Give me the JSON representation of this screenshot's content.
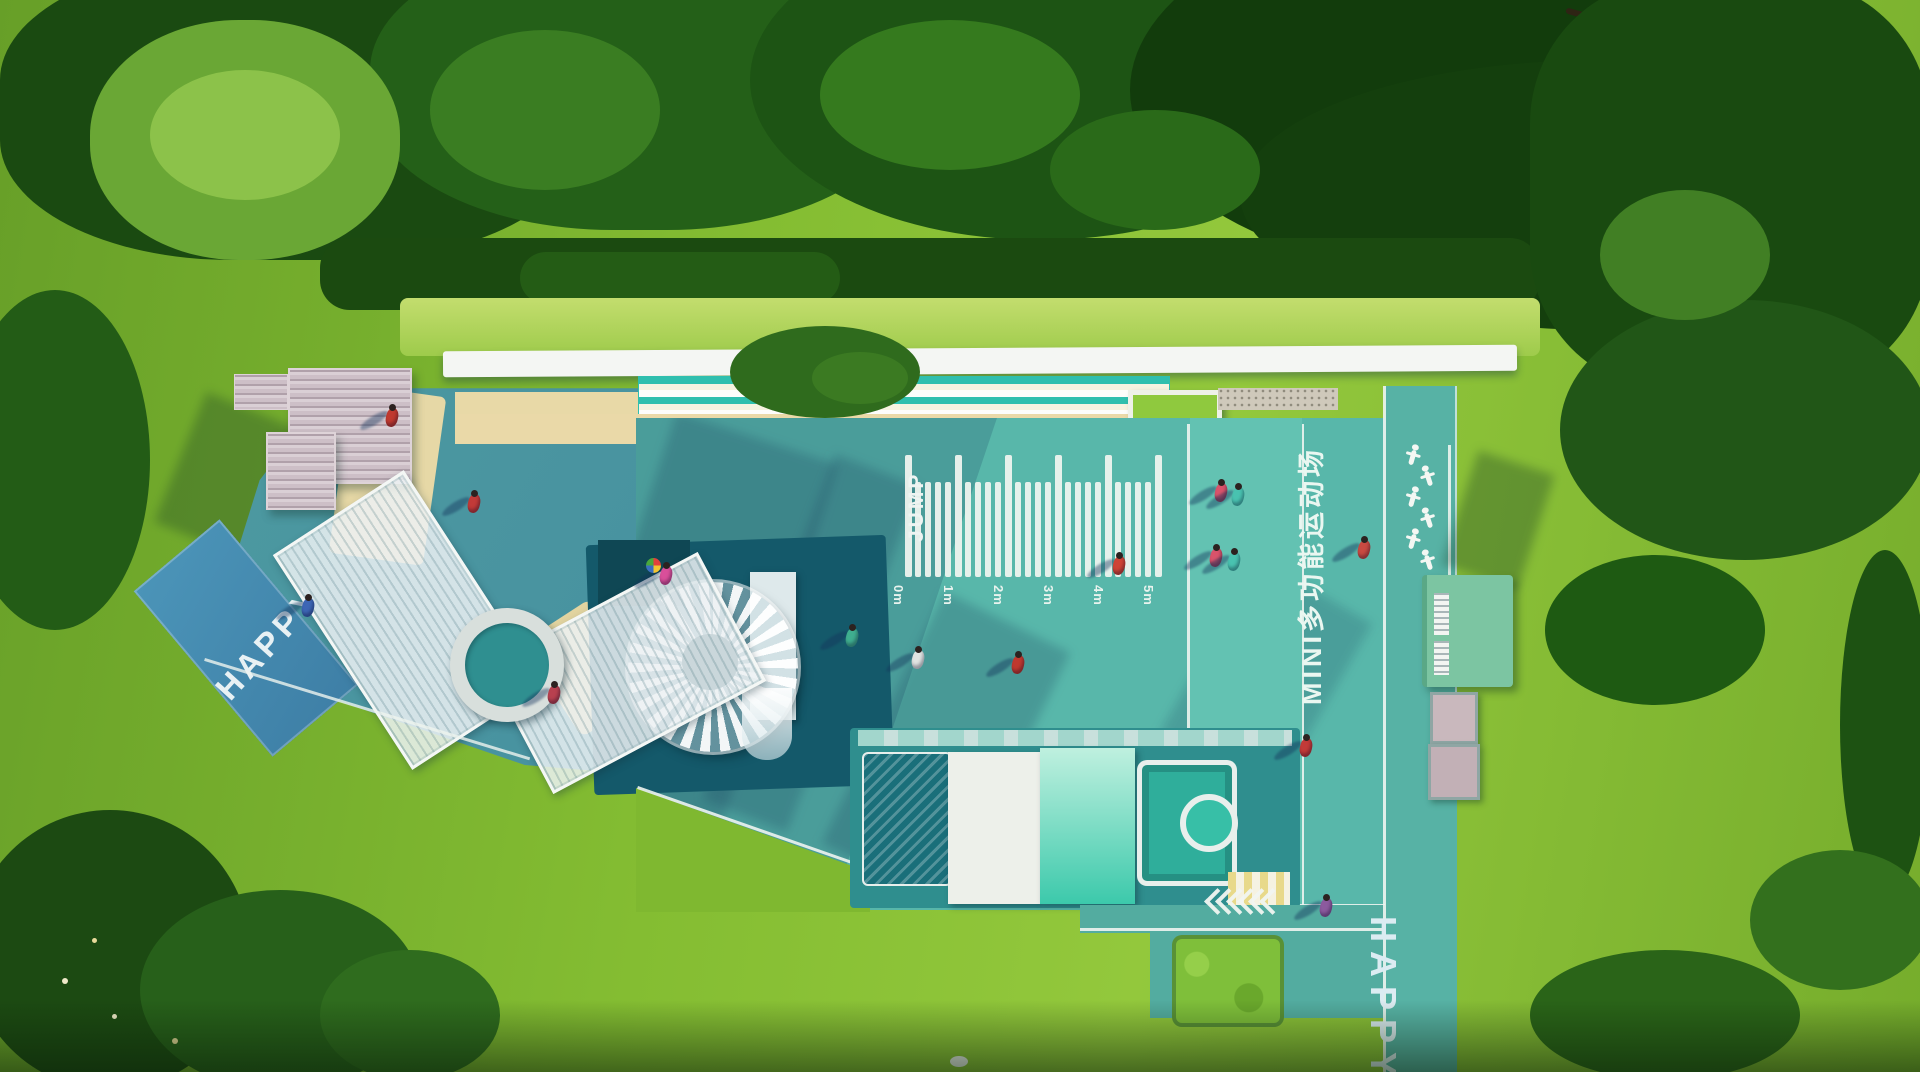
{
  "scene": {
    "description": "Aerial render of a MINI multi-purpose children's sports playground surrounded by lawn and trees",
    "labels": {
      "happy_left": "HAPPY",
      "happy_right": "HAPPY",
      "jump": "JUMP",
      "court_name": "MINI多功能运动场"
    },
    "jump_ruler": {
      "unit_labels": [
        "0m",
        "1m",
        "2m",
        "3m",
        "4m",
        "5m"
      ],
      "minor_ticks_per_interval": 4
    },
    "chevrons": {
      "count": 6,
      "direction": "left"
    },
    "fitness_station": {
      "figure_count": 6
    },
    "colors": {
      "court_teal": "#58b7aa",
      "court_shadow": "#4a9691",
      "dark_play_zone": "#14596a",
      "path_blue": "#4b94b8",
      "sand": "#ead9a8",
      "grass": "#7cb42e",
      "forest": "#1a4a11",
      "white": "#f2f5f2",
      "train_mint": "#3cc9ab",
      "kiosk_green": "#7cc5a2"
    },
    "people": [
      {
        "x": 302,
        "y": 598,
        "c": "#3d66b5"
      },
      {
        "x": 386,
        "y": 408,
        "c": "#c0392f"
      },
      {
        "x": 468,
        "y": 494,
        "c": "#c23a38"
      },
      {
        "x": 548,
        "y": 685,
        "c": "#b8404f"
      },
      {
        "x": 660,
        "y": 566,
        "c": "#d94f9a",
        "pin": true
      },
      {
        "x": 846,
        "y": 628,
        "c": "#3fae8f"
      },
      {
        "x": 912,
        "y": 650,
        "c": "#e0e4e2"
      },
      {
        "x": 1012,
        "y": 655,
        "c": "#c0392f"
      },
      {
        "x": 1113,
        "y": 556,
        "c": "#cf4436"
      },
      {
        "x": 1215,
        "y": 483,
        "c": "#d9536b"
      },
      {
        "x": 1232,
        "y": 487,
        "c": "#49c2b0"
      },
      {
        "x": 1210,
        "y": 548,
        "c": "#d9536b"
      },
      {
        "x": 1228,
        "y": 552,
        "c": "#49c2b0"
      },
      {
        "x": 1300,
        "y": 738,
        "c": "#c23a38"
      },
      {
        "x": 1320,
        "y": 898,
        "c": "#8c5a9e"
      },
      {
        "x": 1358,
        "y": 540,
        "c": "#c94a42"
      }
    ]
  }
}
